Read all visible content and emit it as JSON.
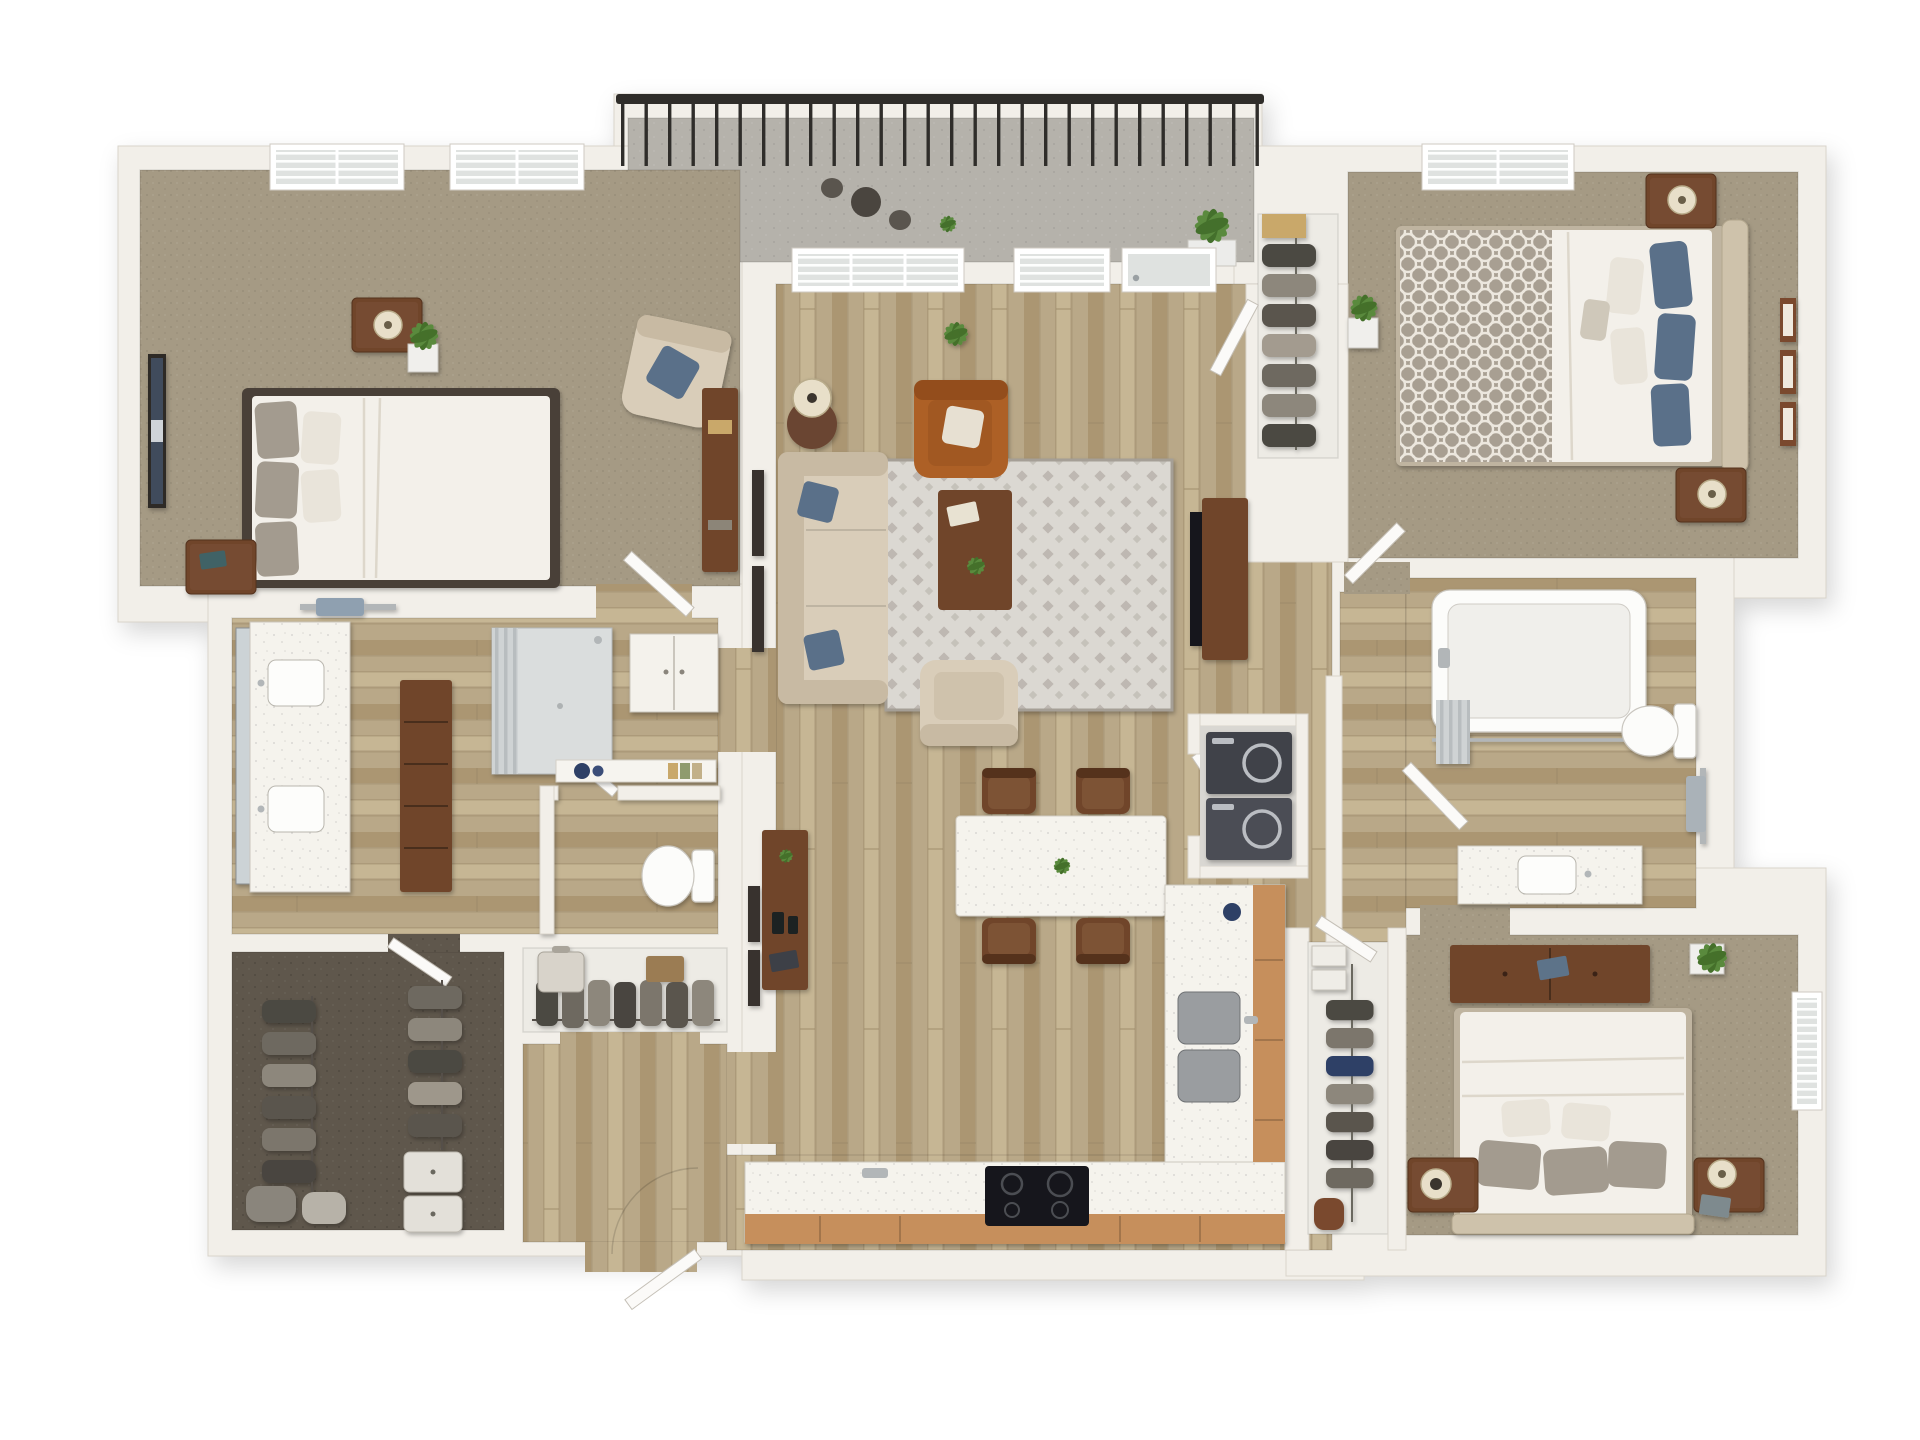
{
  "scene": {
    "kind": "3d-floor-plan-dollhouse-render",
    "background": "#ffffff",
    "rooms": [
      {
        "name": "bedroom-1",
        "floor": "carpet",
        "furniture": [
          "queen-bed-white-duvet-gray-pillows",
          "nightstand-with-lamp",
          "nightstand-with-book",
          "wall-art",
          "potted-plant",
          "accent-chair-blue-pillow",
          "bookcase-desk",
          "window",
          "window"
        ]
      },
      {
        "name": "balcony",
        "floor": "concrete",
        "furniture": [
          "metal-railing",
          "bistro-table",
          "bistro-chair",
          "bistro-chair",
          "potted-plant",
          "potted-plant"
        ]
      },
      {
        "name": "living-room",
        "floor": "hardwood",
        "furniture": [
          "beige-sectional-sofa",
          "patterned-area-rug",
          "coffee-table-with-plant-and-magazine",
          "cognac-leather-armchair-white-pillow",
          "beige-accent-armchair",
          "floor-lamp",
          "round-side-table",
          "tv-console",
          "flat-tv",
          "potted-plant",
          "balcony-glass-door",
          "window",
          "window",
          "wall-frames"
        ]
      },
      {
        "name": "bedroom-2",
        "floor": "carpet",
        "furniture": [
          "queen-bed-upholstered-headboard",
          "trellis-pattern-throw",
          "blue-and-white-pillows",
          "nightstand-with-lamp",
          "nightstand-with-lamp",
          "three-gallery-frames",
          "reach-in-closet-hanging-clothes",
          "potted-plant",
          "window"
        ]
      },
      {
        "name": "master-bathroom",
        "floor": "hardwood",
        "furniture": [
          "double-vanity-two-sinks",
          "wall-mirror",
          "towel-bar-blue-towel",
          "tall-dresser",
          "walk-in-shower-with-curtain",
          "water-closet-toilet",
          "decor-shelf-blue-jars-books",
          "linen-cabinet"
        ]
      },
      {
        "name": "master-closet",
        "floor": "dark-carpet",
        "furniture": [
          "hanging-clothes-rod-west",
          "hanging-clothes-rod-east",
          "storage-bins",
          "storage-bags"
        ]
      },
      {
        "name": "coat-closet",
        "floor": "laminate",
        "furniture": [
          "hanging-coats",
          "suitcase",
          "storage-box"
        ]
      },
      {
        "name": "entry",
        "floor": "hardwood",
        "furniture": [
          "open-front-door"
        ]
      },
      {
        "name": "dining-area",
        "floor": "hardwood",
        "furniture": [
          "white-dining-table",
          "centerpiece-plant",
          "dining-chair",
          "dining-chair",
          "dining-chair",
          "dining-chair",
          "console-table-with-remotes-and-plant",
          "wall-frames"
        ]
      },
      {
        "name": "kitchen",
        "floor": "hardwood",
        "furniture": [
          "l-shaped-counter",
          "wood-base-cabinets",
          "black-cooktop-range",
          "double-basin-sink",
          "faucet"
        ]
      },
      {
        "name": "laundry-closet",
        "floor": "vinyl",
        "furniture": [
          "washer",
          "dryer"
        ]
      },
      {
        "name": "bathroom-2",
        "floor": "hardwood",
        "furniture": [
          "bathtub-with-curtain-rod",
          "toilet",
          "vanity-sink",
          "towel-bar-gray-towel"
        ]
      },
      {
        "name": "bedroom-3",
        "floor": "carpet",
        "furniture": [
          "queen-bed-white-duvet-gray-pillows",
          "upholstered-headboard",
          "wide-dresser-with-book",
          "nightstand-with-round-lamp",
          "nightstand-with-lamp-and-laptop",
          "walk-in-closet-hanging-clothes-shoes",
          "potted-plant",
          "window"
        ]
      }
    ],
    "counts": {
      "balcony_railing_posts": 27,
      "bedroom1_windows": 2,
      "bedroom2_gallery_frames": 3,
      "dining_chairs": 4,
      "master_closet_bins": 3,
      "coat_closet_coats": 7
    },
    "colors": {
      "wall": "#f2efe9",
      "wall_edge": "#d9d4cb",
      "carpet": "#a59a84",
      "carpet_dark": "#5f574c",
      "wood": "#b9a888",
      "wood_dark": "#ab9672",
      "wood_light": "#c6b694",
      "wood_seam": "#9c8a68",
      "balcony": "#b5b2ab",
      "railing": "#2f2d2a",
      "cabinet": "#c68f5c",
      "cabinet_dark": "#b07a45",
      "counter": "#f5f3ed",
      "furn_wood": "#6f452c",
      "furn_wood_dark": "#55331f",
      "sofa": "#d9cdb9",
      "sofa_dark": "#c8baa3",
      "leather": "#ad6127",
      "leather_dark": "#934e1d",
      "duvet": "#f3f0ea",
      "duvet_shade": "#ddd7cb",
      "pillow_gray": "#a39b8f",
      "pillow_blue": "#5a7089",
      "headboard": "#cec2ab",
      "rug": "#dbd8d2",
      "rug_accent": "#a59f96",
      "plant": "#5a8a3e",
      "plant_dark": "#44702c",
      "appliance": "#41434a",
      "glass": "#dfe2e0",
      "porcelain": "#fcfcfa",
      "steel": "#b2b6b8",
      "towel_blue": "#8fa0b0",
      "mirror": "#ccd3d6",
      "floor_white": "#edebe5",
      "laundry_floor": "#d9d7d2",
      "art_navy": "#414b5c",
      "tan": "#c9a86b"
    }
  }
}
